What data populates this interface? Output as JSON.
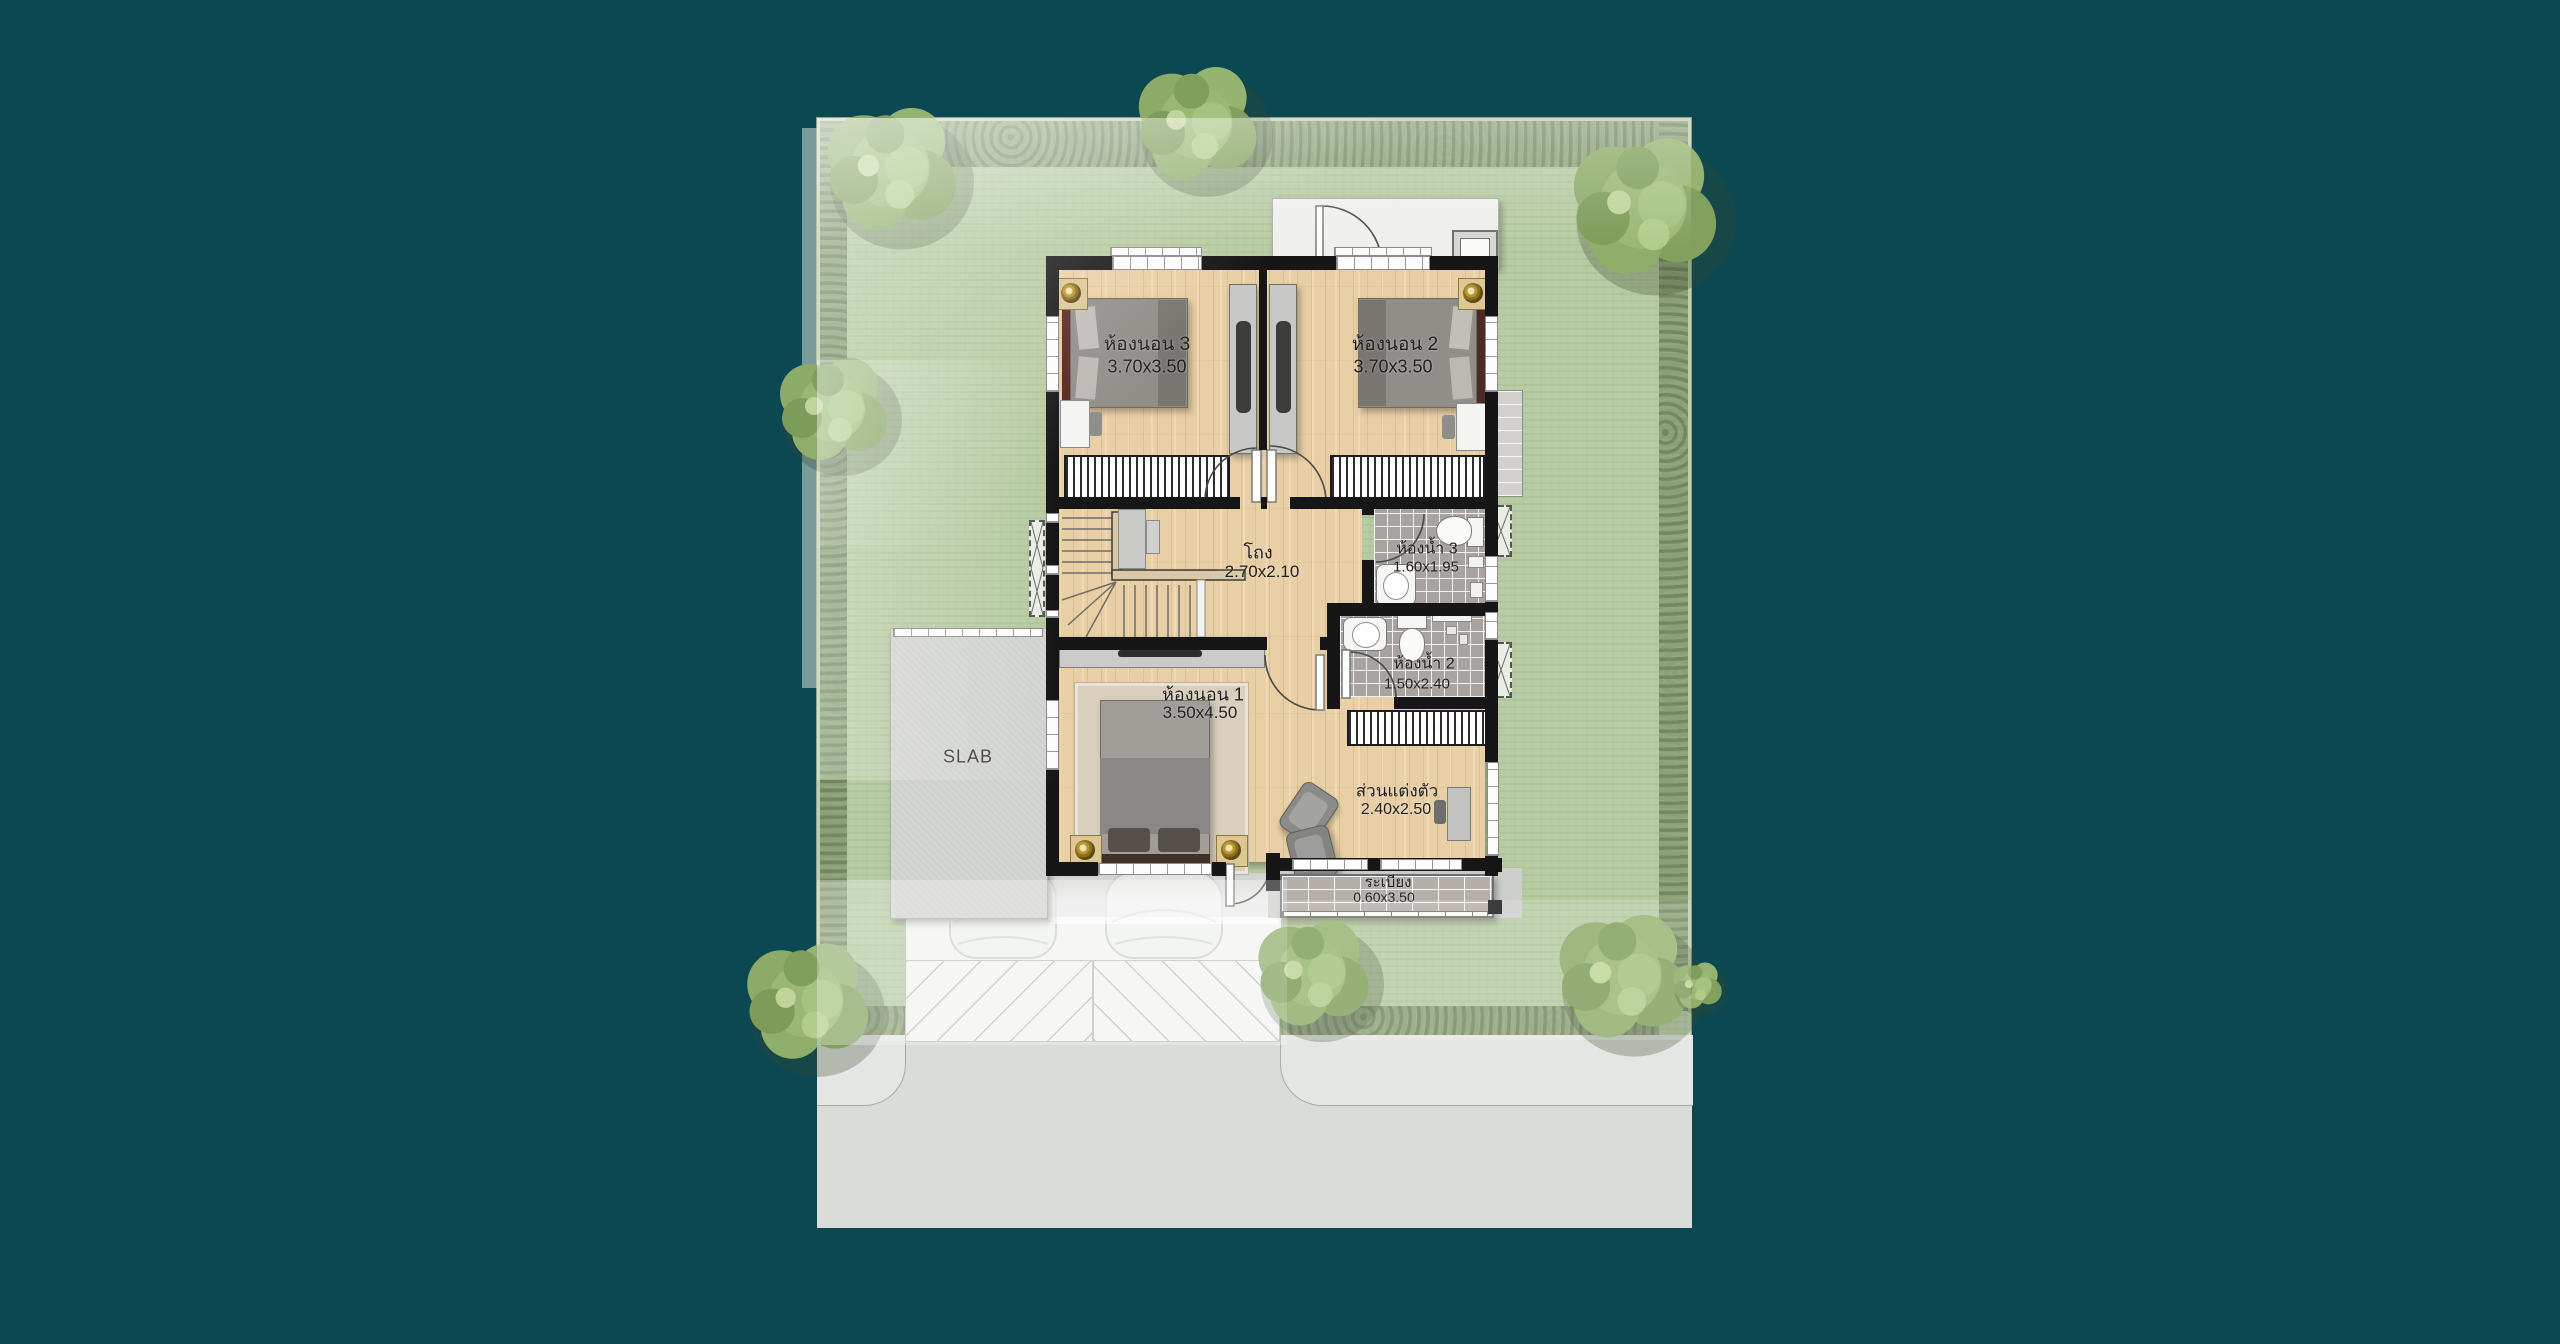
{
  "plan": {
    "type": "floor-plan",
    "floor": "second-floor",
    "rooms": {
      "bedroom3": {
        "name": "ห้องนอน 3",
        "dim": "3.70x3.50"
      },
      "bedroom2": {
        "name": "ห้องนอน 2",
        "dim": "3.70x3.50"
      },
      "bedroom1": {
        "name": "ห้องนอน 1",
        "dim": "3.50x4.50"
      },
      "hall": {
        "name": "โถง",
        "dim": "2.70x2.10"
      },
      "bath3": {
        "name": "ห้องน้ำ 3",
        "dim": "1.60x1.95"
      },
      "bath2": {
        "name": "ห้องน้ำ 2",
        "dim": "1.50x2.40"
      },
      "dressing": {
        "name": "ส่วนแต่งตัว",
        "dim": "2.40x2.50"
      },
      "balcony": {
        "name": "ระเบียง",
        "dim": "0.60x3.50"
      },
      "slab": {
        "name": "SLAB"
      }
    },
    "colors": {
      "background": "#0c4852",
      "grass": "#b7cca3",
      "hedge": "#8ca078",
      "wood_floor": "#e9cfa5",
      "bath_tile": "#a8a39e",
      "balcony_tile": "#b4afa9",
      "concrete": "#d3d5d2",
      "wall": "#161616",
      "road": "#d9dcd8"
    }
  }
}
